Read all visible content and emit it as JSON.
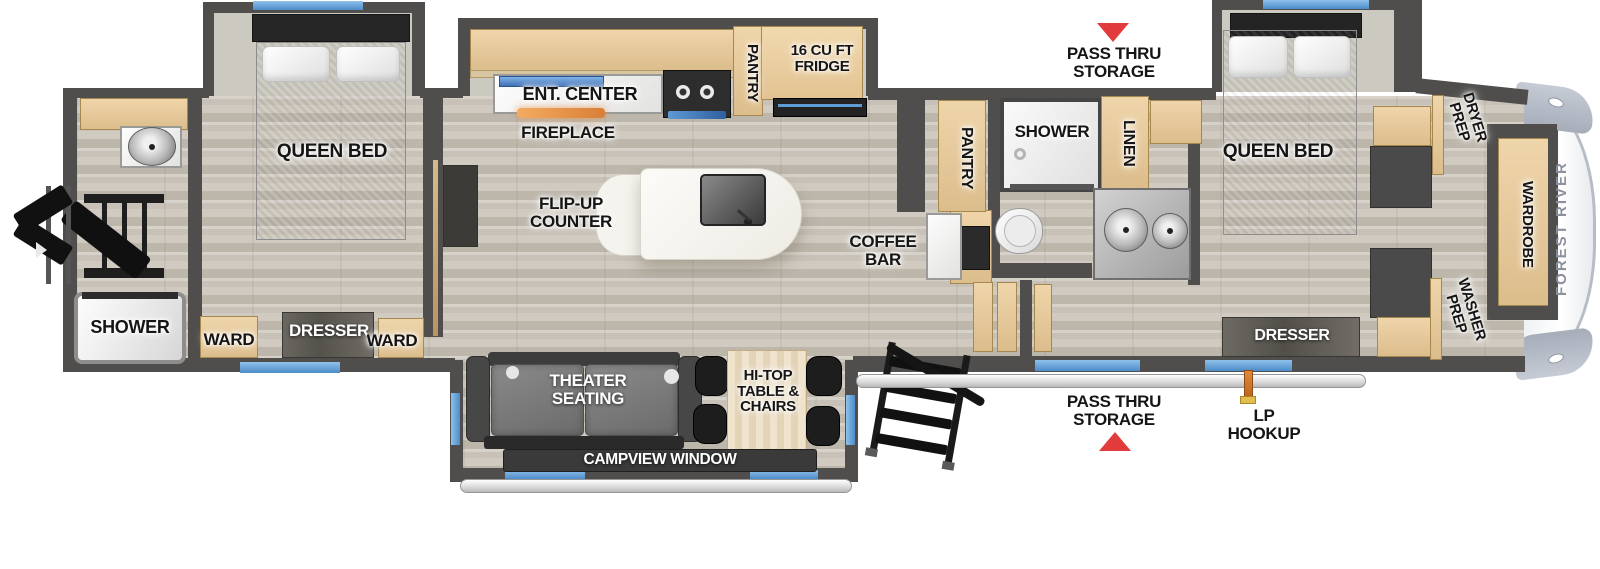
{
  "floorplan": {
    "brand_label": "FOREST RIVER",
    "rear_bath": {
      "shower_label": "SHOWER"
    },
    "bedroom_left": {
      "queen_bed_label": "QUEEN BED",
      "ward_left_label": "WARD",
      "dresser_label": "DRESSER",
      "ward_right_label": "WARD"
    },
    "kitchen": {
      "ent_center_label": "ENT. CENTER",
      "fireplace_label": "FIREPLACE",
      "pantry_label": "PANTRY",
      "fridge_label": "16 CU FT FRIDGE",
      "flip_up_counter_label": "FLIP-UP COUNTER",
      "coffee_bar_label": "COFFEE BAR"
    },
    "living": {
      "theater_seating_label": "THEATER SEATING",
      "hi_top_label": "HI-TOP TABLE & CHAIRS",
      "campview_label": "CAMPVIEW WINDOW"
    },
    "main_bath": {
      "pantry_label": "PANTRY",
      "shower_label": "SHOWER",
      "linen_label": "LINEN"
    },
    "bedroom_right": {
      "queen_bed_label": "QUEEN BED",
      "dresser_label": "DRESSER",
      "dryer_prep_label": "DRYER PREP",
      "washer_prep_label": "WASHER PREP",
      "wardrobe_label": "WARDROBE"
    },
    "exterior": {
      "pass_thru_top_label": "PASS THRU STORAGE",
      "pass_thru_bottom_label": "PASS THRU STORAGE",
      "lp_hookup_label": "LP HOOKUP"
    }
  },
  "colors": {
    "wall": "#4f4e4c",
    "floor": "#c8c2b8",
    "cabinet": "#e4c89e",
    "slide_interior": "#ccc9c0",
    "window_blue": "#64a0d8",
    "arrow_red": "#e23b3b",
    "fireplace_orange": "#e8944b",
    "tv_blue": "#4f7fc2",
    "brand_gray": "#8b919c",
    "lp_orange": "#d97b2e"
  }
}
